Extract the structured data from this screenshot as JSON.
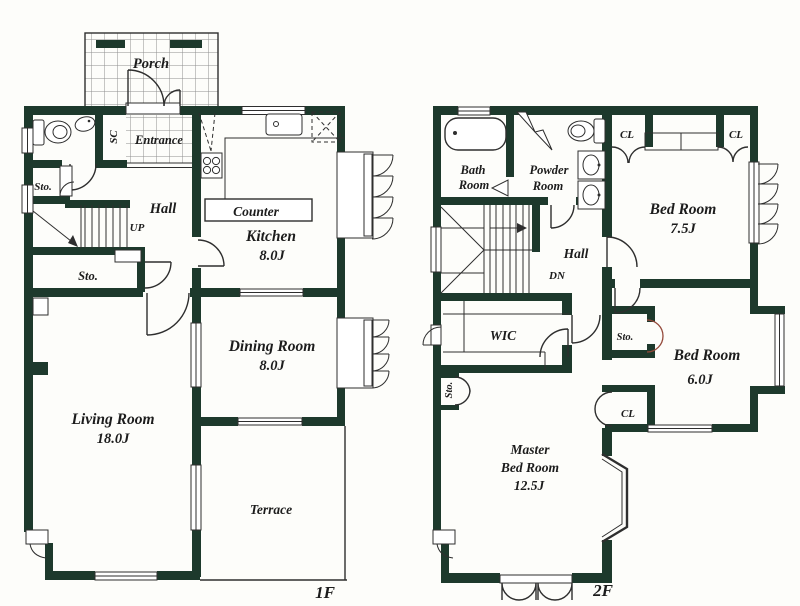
{
  "colors": {
    "wall": "#1d392c",
    "line": "#2e2e2e",
    "accent_red": "#94493a",
    "paper": "#fdfdfa"
  },
  "f1": {
    "floor_label": "1F",
    "porch": "Porch",
    "sc": "SC",
    "entrance": "Entrance",
    "sto_upper": "Sto.",
    "hall": "Hall",
    "up": "UP",
    "sto_lower": "Sto.",
    "counter": "Counter",
    "kitchen": "Kitchen",
    "kitchen_size": "8.0J",
    "dining": "Dining Room",
    "dining_size": "8.0J",
    "living": "Living Room",
    "living_size": "18.0J",
    "terrace": "Terrace"
  },
  "f2": {
    "floor_label": "2F",
    "bath_line1": "Bath",
    "bath_line2": "Room",
    "powder_line1": "Powder",
    "powder_line2": "Room",
    "closet": "CL",
    "bed1": "Bed Room",
    "bed1_size": "7.5J",
    "hall": "Hall",
    "dn": "DN",
    "wic": "WIC",
    "sto": "Sto.",
    "bed2": "Bed Room",
    "bed2_size": "6.0J",
    "master_line1": "Master",
    "master_line2": "Bed Room",
    "master_size": "12.5J"
  }
}
